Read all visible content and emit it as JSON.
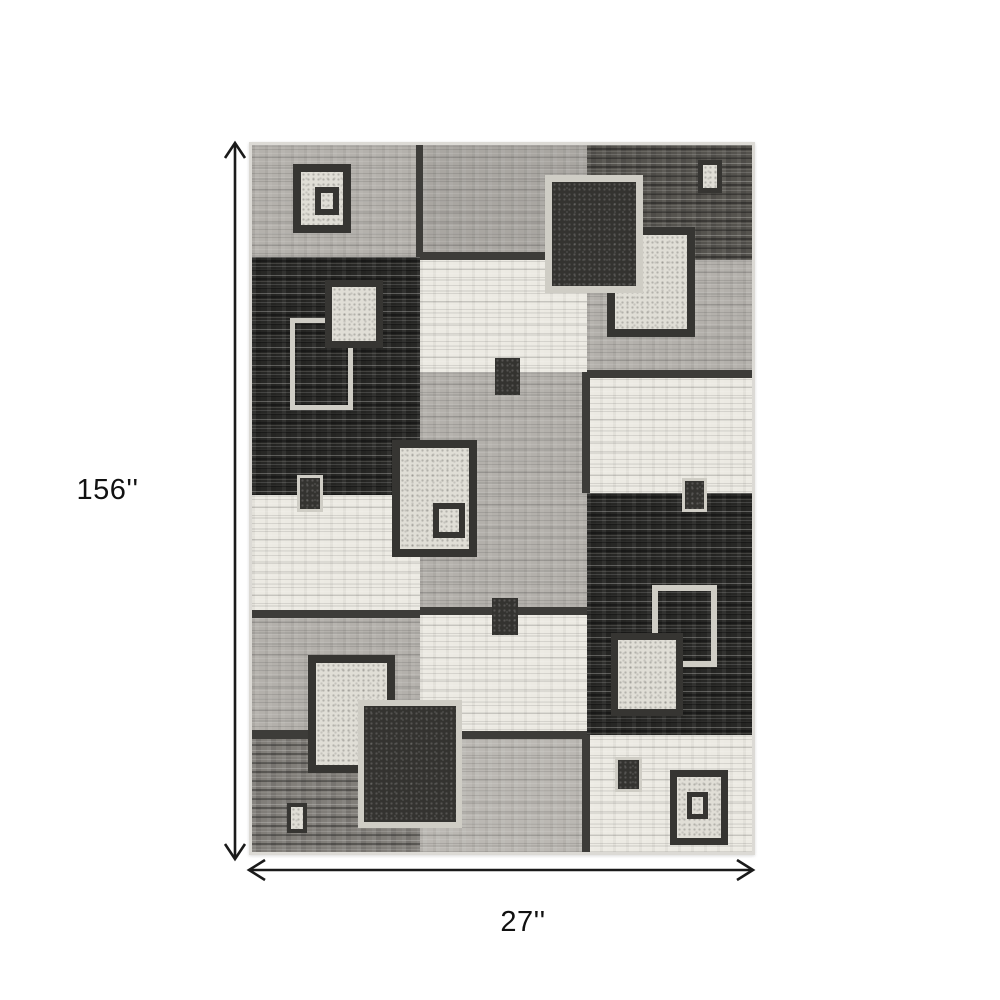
{
  "figure": {
    "type": "product-dimension-diagram",
    "height_label": "156''",
    "width_label": "27''"
  },
  "palette": {
    "background": "#ffffff",
    "arrow": "#1a1a1a",
    "label_text": "#111111",
    "rug_edge": "#dcdad5",
    "gray1": "#b4b1ac",
    "gray2": "#a9a6a1",
    "gray3": "#b3b0ab",
    "gray4": "#bbb8b3",
    "gray5": "#817e79",
    "dark1": "#55534e",
    "black1": "#272725",
    "cream": "#eceae3",
    "seam": "#3d3c39",
    "border_dark": "#363532",
    "border_light": "#cfcdc5",
    "fill_light": "#e0ded6",
    "fill_dark": "#343330"
  },
  "rug_pattern": {
    "x": 252,
    "y": 145,
    "width": 500,
    "height": 707,
    "blocks": [
      {
        "name": "col1-row1",
        "x": 0,
        "y": 0,
        "w": 168,
        "h": 112,
        "tone": "gray1",
        "strong": false
      },
      {
        "name": "col1-row2",
        "x": 0,
        "y": 112,
        "w": 168,
        "h": 238,
        "tone": "black1",
        "strong": true
      },
      {
        "name": "col1-row3",
        "x": 0,
        "y": 350,
        "w": 168,
        "h": 115,
        "tone": "cream",
        "strong": false
      },
      {
        "name": "col1-row4",
        "x": 0,
        "y": 465,
        "w": 168,
        "h": 122,
        "tone": "gray3",
        "strong": false
      },
      {
        "name": "col1-row5",
        "x": 0,
        "y": 587,
        "w": 168,
        "h": 120,
        "tone": "gray5",
        "strong": true
      },
      {
        "name": "col2-row1",
        "x": 168,
        "y": 0,
        "w": 167,
        "h": 112,
        "tone": "gray2",
        "strong": false
      },
      {
        "name": "col2-row2",
        "x": 168,
        "y": 112,
        "w": 167,
        "h": 115,
        "tone": "cream",
        "strong": false
      },
      {
        "name": "col2-row3",
        "x": 168,
        "y": 227,
        "w": 167,
        "h": 241,
        "tone": "gray3",
        "strong": false
      },
      {
        "name": "col2-row4",
        "x": 168,
        "y": 468,
        "w": 167,
        "h": 122,
        "tone": "cream",
        "strong": false
      },
      {
        "name": "col2-row5",
        "x": 168,
        "y": 590,
        "w": 167,
        "h": 117,
        "tone": "gray4",
        "strong": false
      },
      {
        "name": "col3-row1",
        "x": 335,
        "y": 0,
        "w": 165,
        "h": 115,
        "tone": "dark1",
        "strong": true
      },
      {
        "name": "col3-row2",
        "x": 335,
        "y": 115,
        "w": 165,
        "h": 115,
        "tone": "gray3",
        "strong": false
      },
      {
        "name": "col3-row3",
        "x": 335,
        "y": 230,
        "w": 165,
        "h": 118,
        "tone": "cream",
        "strong": false
      },
      {
        "name": "col3-row4",
        "x": 335,
        "y": 348,
        "w": 165,
        "h": 242,
        "tone": "black1",
        "strong": true
      },
      {
        "name": "col3-row5",
        "x": 335,
        "y": 590,
        "w": 165,
        "h": 117,
        "tone": "cream",
        "strong": false
      }
    ],
    "seams": [
      {
        "x": 164,
        "y": 0,
        "w": 7,
        "h": 112
      },
      {
        "x": 168,
        "y": 107,
        "w": 167,
        "h": 8
      },
      {
        "x": 168,
        "y": 462,
        "w": 167,
        "h": 8
      },
      {
        "x": 168,
        "y": 586,
        "w": 167,
        "h": 8
      },
      {
        "x": 335,
        "y": 225,
        "w": 165,
        "h": 8
      },
      {
        "x": 330,
        "y": 227,
        "w": 8,
        "h": 121
      },
      {
        "x": 330,
        "y": 590,
        "w": 8,
        "h": 117
      },
      {
        "x": 0,
        "y": 465,
        "w": 168,
        "h": 8
      },
      {
        "x": 0,
        "y": 585,
        "w": 168,
        "h": 9
      }
    ],
    "squares": [
      {
        "name": "motif-double-square-top-left-outer",
        "x": 41,
        "y": 19,
        "w": 58,
        "h": 69,
        "bw": 8,
        "border": "border_dark",
        "fill": "fill_light"
      },
      {
        "name": "motif-double-square-top-left-inner",
        "x": 63,
        "y": 42,
        "w": 24,
        "h": 28,
        "bw": 6,
        "border": "border_dark",
        "fill": "fill_light"
      },
      {
        "name": "motif-outline-square-left",
        "x": 38,
        "y": 173,
        "w": 63,
        "h": 92,
        "bw": 5,
        "border": "border_light",
        "fill": null
      },
      {
        "name": "motif-light-square-left",
        "x": 73,
        "y": 135,
        "w": 58,
        "h": 68,
        "bw": 7,
        "border": "border_dark",
        "fill": "fill_light"
      },
      {
        "name": "motif-small-square-left-mid",
        "x": 45,
        "y": 330,
        "w": 26,
        "h": 37,
        "bw": 3,
        "border": "border_light",
        "fill": "fill_dark"
      },
      {
        "name": "motif-light-square-top-right",
        "x": 355,
        "y": 82,
        "w": 88,
        "h": 110,
        "bw": 8,
        "border": "border_dark",
        "fill": "fill_light"
      },
      {
        "name": "motif-dark-square-top-right",
        "x": 293,
        "y": 30,
        "w": 98,
        "h": 118,
        "bw": 7,
        "border": "border_light",
        "fill": "fill_dark"
      },
      {
        "name": "motif-small-square-top-right",
        "x": 446,
        "y": 15,
        "w": 24,
        "h": 33,
        "bw": 5,
        "border": "border_dark",
        "fill": "fill_light"
      },
      {
        "name": "motif-double-square-center-outer",
        "x": 140,
        "y": 295,
        "w": 85,
        "h": 117,
        "bw": 8,
        "border": "border_dark",
        "fill": "fill_light"
      },
      {
        "name": "motif-double-square-center-inner",
        "x": 181,
        "y": 358,
        "w": 32,
        "h": 35,
        "bw": 6,
        "border": "border_dark",
        "fill": "fill_light"
      },
      {
        "name": "motif-solid-square-center-top",
        "x": 243,
        "y": 213,
        "w": 25,
        "h": 37,
        "bw": 0,
        "border": null,
        "fill": "fill_dark"
      },
      {
        "name": "motif-solid-square-center-bottom",
        "x": 240,
        "y": 453,
        "w": 26,
        "h": 37,
        "bw": 0,
        "border": null,
        "fill": "fill_dark"
      },
      {
        "name": "motif-small-square-right-mid",
        "x": 430,
        "y": 333,
        "w": 25,
        "h": 34,
        "bw": 3,
        "border": "border_light",
        "fill": "fill_dark"
      },
      {
        "name": "motif-outline-square-right",
        "x": 400,
        "y": 440,
        "w": 65,
        "h": 82,
        "bw": 6,
        "border": "border_light",
        "fill": null
      },
      {
        "name": "motif-light-square-right",
        "x": 359,
        "y": 488,
        "w": 72,
        "h": 83,
        "bw": 7,
        "border": "border_dark",
        "fill": "fill_light"
      },
      {
        "name": "motif-light-square-bottom-left",
        "x": 56,
        "y": 510,
        "w": 87,
        "h": 118,
        "bw": 8,
        "border": "border_dark",
        "fill": "fill_light"
      },
      {
        "name": "motif-dark-square-bottom-left",
        "x": 106,
        "y": 555,
        "w": 104,
        "h": 128,
        "bw": 6,
        "border": "border_light",
        "fill": "fill_dark"
      },
      {
        "name": "motif-small-square-bottom-left",
        "x": 35,
        "y": 658,
        "w": 20,
        "h": 30,
        "bw": 4,
        "border": "border_dark",
        "fill": "fill_light"
      },
      {
        "name": "motif-small-square-bottom-right",
        "x": 363,
        "y": 612,
        "w": 27,
        "h": 35,
        "bw": 3,
        "border": "border_light",
        "fill": "fill_dark"
      },
      {
        "name": "motif-double-square-bottom-right-outer",
        "x": 418,
        "y": 625,
        "w": 58,
        "h": 75,
        "bw": 7,
        "border": "border_dark",
        "fill": "fill_light"
      },
      {
        "name": "motif-double-square-bottom-right-inner",
        "x": 435,
        "y": 647,
        "w": 21,
        "h": 27,
        "bw": 5,
        "border": "border_dark",
        "fill": "fill_light"
      }
    ]
  },
  "arrows": {
    "vertical": {
      "x": 235,
      "y1": 143,
      "y2": 859
    },
    "horizontal": {
      "y": 870,
      "x1": 249,
      "x2": 753
    }
  }
}
